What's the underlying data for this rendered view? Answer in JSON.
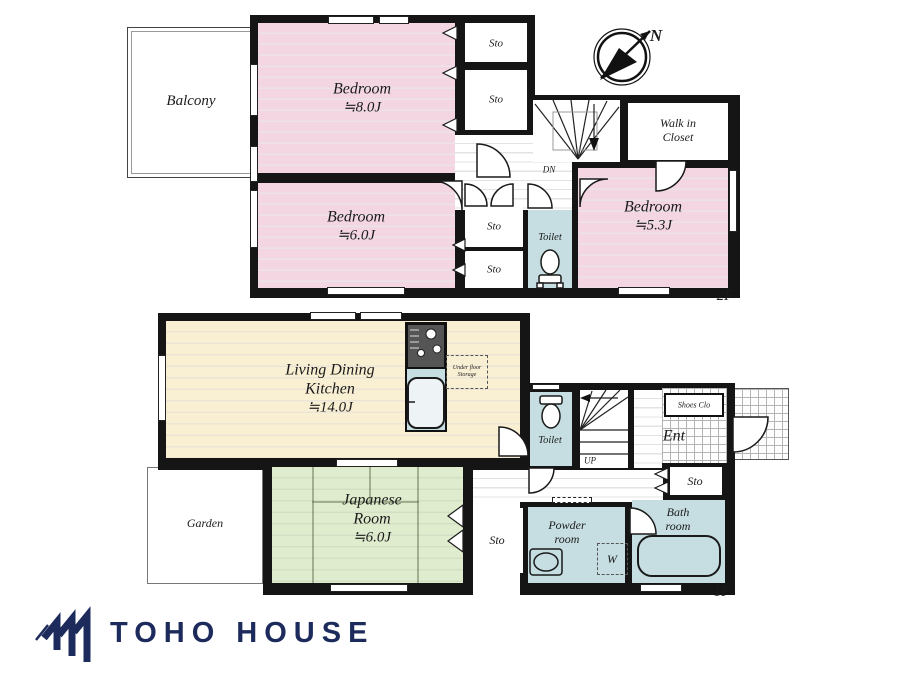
{
  "colors": {
    "pink": "#f3d6e2",
    "cream": "#f9efd3",
    "green": "#e0ecce",
    "blue": "#c6dee2",
    "wall": "#151515",
    "navy": "#1c2b5c"
  },
  "compass": {
    "north": "N"
  },
  "floor2": {
    "floor_label": "2F",
    "balcony": "Balcony",
    "bedroom8": {
      "name": "Bedroom",
      "size": "≒8.0J"
    },
    "bedroom6": {
      "name": "Bedroom",
      "size": "≒6.0J"
    },
    "bedroom53": {
      "name": "Bedroom",
      "size": "≒5.3J"
    },
    "sto_top": "Sto",
    "sto_mid": "Sto",
    "sto_small_upper": "Sto",
    "sto_small_lower": "Sto",
    "walk_in_closet": {
      "line1": "Walk in",
      "line2": "Closet"
    },
    "toilet": "Toilet",
    "dn": "DN"
  },
  "floor1": {
    "floor_label": "1F",
    "ldk": {
      "line1": "Living Dining",
      "line2": "Kitchen",
      "size": "≒14.0J"
    },
    "under_floor_storage": {
      "line1": "Under floor",
      "line2": "Storage"
    },
    "toilet": "Toilet",
    "up": "UP",
    "shoes_closet": "Shoes Clo",
    "entrance": "Ent",
    "sto_entrance": "Sto",
    "sto_hall": "Sto",
    "powder_room": {
      "line1": "Powder",
      "line2": "room"
    },
    "washer": "W",
    "bath_room": {
      "line1": "Bath",
      "line2": "room"
    },
    "japanese_room": {
      "line1": "Japanese",
      "line2": "Room",
      "size": "≒6.0J"
    },
    "garden": "Garden"
  },
  "brand": {
    "logo_text": "TOHO HOUSE"
  }
}
